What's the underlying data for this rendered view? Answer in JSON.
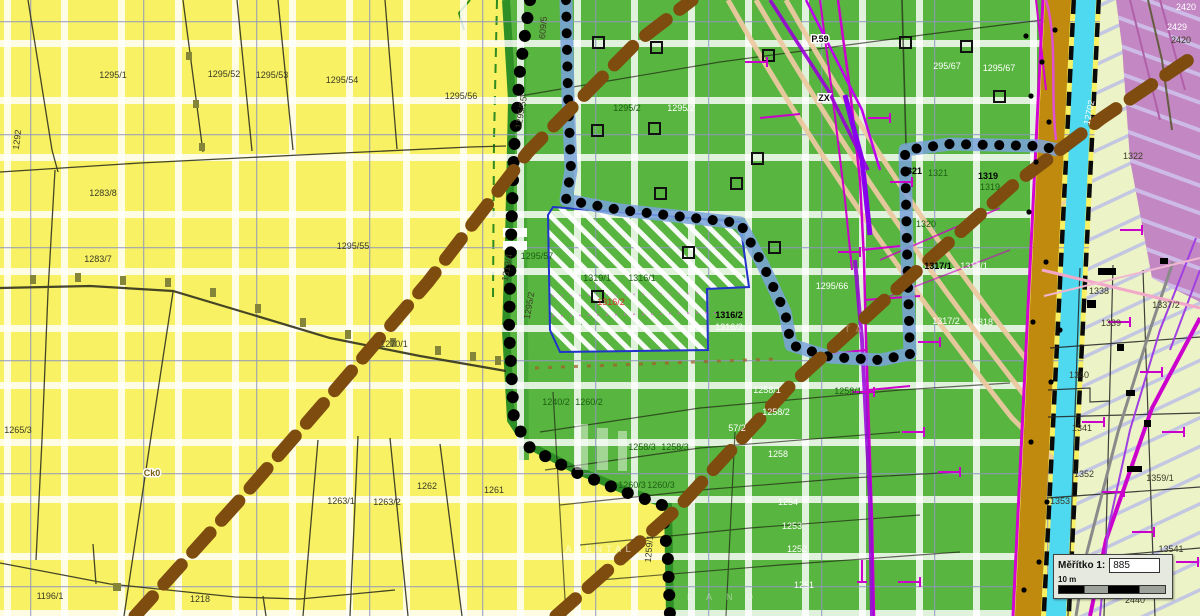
{
  "map": {
    "region_labels": {
      "plan_code": "P.59",
      "zone_code": "ZX",
      "area_code": "Ck0"
    },
    "watermark": {
      "line1": "ASENTAL",
      "line2": "LAND",
      "fragment": "TAL"
    },
    "scalebox": {
      "label": "Měřítko 1:",
      "value": "885",
      "bar_label": "10 m"
    },
    "colors": {
      "farmland_yellow": "#f7f163",
      "zone_green": "#58b53f",
      "boundary_blue_band": "#7aa2dc",
      "corridor_ochre": "#bf8a0e",
      "corridor_cyan": "#4ed9f0",
      "mauve_zone": "#c387c3",
      "pale_parcels": "#ecf3c6",
      "utility_magenta": "#cc00cc",
      "plan_line_brown": "#7e4c0f",
      "subject_outline_blue": "#2233cc"
    },
    "labels": [
      {
        "t": "1292",
        "x": 20,
        "y": 140,
        "c": "dk",
        "r": -83
      },
      {
        "t": "1295/1",
        "x": 113,
        "y": 78,
        "c": "dk"
      },
      {
        "t": "1295/52",
        "x": 224,
        "y": 77,
        "c": "dk"
      },
      {
        "t": "1295/53",
        "x": 272,
        "y": 78,
        "c": "dk"
      },
      {
        "t": "1295/54",
        "x": 342,
        "y": 83,
        "c": "dk"
      },
      {
        "t": "1295/56",
        "x": 461,
        "y": 99,
        "c": "dk"
      },
      {
        "t": "1283/8",
        "x": 103,
        "y": 196,
        "c": "dk"
      },
      {
        "t": "1283/7",
        "x": 98,
        "y": 262,
        "c": "dk"
      },
      {
        "t": "1295/55",
        "x": 353,
        "y": 249,
        "c": "dk"
      },
      {
        "t": "1270/1",
        "x": 394,
        "y": 347,
        "c": "dk"
      },
      {
        "t": "1265/3",
        "x": 18,
        "y": 433,
        "c": "dk"
      },
      {
        "t": "1263/1",
        "x": 341,
        "y": 504,
        "c": "dk"
      },
      {
        "t": "1263/2",
        "x": 387,
        "y": 505,
        "c": "dk"
      },
      {
        "t": "1262",
        "x": 427,
        "y": 489,
        "c": "dk"
      },
      {
        "t": "1261",
        "x": 494,
        "y": 493,
        "c": "dk"
      },
      {
        "t": "1218",
        "x": 200,
        "y": 602,
        "c": "dk"
      },
      {
        "t": "1196/1",
        "x": 50,
        "y": 599,
        "c": "dk"
      },
      {
        "t": "1295/55",
        "x": 524,
        "y": 113,
        "c": "dk",
        "r": -80
      },
      {
        "t": "609/5",
        "x": 546,
        "y": 28,
        "c": "dk",
        "r": -85
      },
      {
        "t": "295/67",
        "x": 947,
        "y": 69,
        "c": "wh"
      },
      {
        "t": "1295/67",
        "x": 999,
        "y": 71,
        "c": "wh"
      },
      {
        "t": "1295/2",
        "x": 627,
        "y": 111,
        "c": "gn"
      },
      {
        "t": "1295/2",
        "x": 681,
        "y": 111,
        "c": "wh"
      },
      {
        "t": "1295/57",
        "x": 537,
        "y": 259,
        "c": "gn"
      },
      {
        "t": "1319/1",
        "x": 597,
        "y": 281,
        "c": "gn"
      },
      {
        "t": "1316/1",
        "x": 642,
        "y": 281,
        "c": "gn"
      },
      {
        "t": "1316/2",
        "x": 611,
        "y": 305,
        "c": "rd"
      },
      {
        "t": "1316/2",
        "x": 729,
        "y": 318,
        "c": "bk"
      },
      {
        "t": "1316/2",
        "x": 729,
        "y": 330,
        "c": "wh"
      },
      {
        "t": "1321",
        "x": 912,
        "y": 174,
        "c": "bk"
      },
      {
        "t": "1321",
        "x": 938,
        "y": 176,
        "c": "gn"
      },
      {
        "t": "1319",
        "x": 988,
        "y": 179,
        "c": "bk"
      },
      {
        "t": "1319",
        "x": 990,
        "y": 190,
        "c": "gn"
      },
      {
        "t": "1320",
        "x": 926,
        "y": 227,
        "c": "gn"
      },
      {
        "t": "1317/1",
        "x": 938,
        "y": 269,
        "c": "bk"
      },
      {
        "t": "1317/1",
        "x": 974,
        "y": 269,
        "c": "wh"
      },
      {
        "t": "1295/66",
        "x": 832,
        "y": 289,
        "c": "wh"
      },
      {
        "t": "1317/2",
        "x": 946,
        "y": 324,
        "c": "wh"
      },
      {
        "t": "1318",
        "x": 983,
        "y": 325,
        "c": "wh"
      },
      {
        "t": "1258/1",
        "x": 767,
        "y": 393,
        "c": "wh"
      },
      {
        "t": "1258/1",
        "x": 848,
        "y": 394,
        "c": "gn"
      },
      {
        "t": "1258/2",
        "x": 776,
        "y": 415,
        "c": "wh"
      },
      {
        "t": "1240/2",
        "x": 556,
        "y": 405,
        "c": "gn"
      },
      {
        "t": "1260/2",
        "x": 589,
        "y": 405,
        "c": "gn"
      },
      {
        "t": "1258/3",
        "x": 642,
        "y": 450,
        "c": "gn"
      },
      {
        "t": "1258/3",
        "x": 675,
        "y": 450,
        "c": "gn"
      },
      {
        "t": "57/2",
        "x": 737,
        "y": 431,
        "c": "wh"
      },
      {
        "t": "1258",
        "x": 778,
        "y": 457,
        "c": "wh"
      },
      {
        "t": "1254",
        "x": 788,
        "y": 505,
        "c": "wh"
      },
      {
        "t": "1253",
        "x": 792,
        "y": 529,
        "c": "wh"
      },
      {
        "t": "1252",
        "x": 797,
        "y": 552,
        "c": "wh"
      },
      {
        "t": "1251",
        "x": 804,
        "y": 588,
        "c": "wh"
      },
      {
        "t": "1260/3",
        "x": 632,
        "y": 488,
        "c": "gn"
      },
      {
        "t": "1260/3",
        "x": 661,
        "y": 488,
        "c": "gn"
      },
      {
        "t": "1259/1",
        "x": 652,
        "y": 549,
        "c": "dk",
        "r": -85
      },
      {
        "t": "1295/2",
        "x": 532,
        "y": 306,
        "c": "dk",
        "r": -80
      },
      {
        "t": "1319/4",
        "x": 510,
        "y": 268,
        "c": "dk",
        "r": -80
      },
      {
        "t": "12702",
        "x": 1092,
        "y": 113,
        "c": "wh",
        "r": -78
      },
      {
        "t": "2420",
        "x": 1186,
        "y": 10,
        "c": "wh"
      },
      {
        "t": "2429",
        "x": 1177,
        "y": 30,
        "c": "wh"
      },
      {
        "t": "2420",
        "x": 1181,
        "y": 43,
        "c": "dk"
      },
      {
        "t": "1322",
        "x": 1133,
        "y": 159,
        "c": "dk"
      },
      {
        "t": "1337/2",
        "x": 1166,
        "y": 308,
        "c": "dk"
      },
      {
        "t": "1338",
        "x": 1099,
        "y": 294,
        "c": "dk"
      },
      {
        "t": "1339",
        "x": 1111,
        "y": 326,
        "c": "dk"
      },
      {
        "t": "1340",
        "x": 1079,
        "y": 378,
        "c": "dk"
      },
      {
        "t": "1341",
        "x": 1082,
        "y": 431,
        "c": "dk"
      },
      {
        "t": "1352",
        "x": 1084,
        "y": 477,
        "c": "dk"
      },
      {
        "t": "1353",
        "x": 1060,
        "y": 504,
        "c": "dk"
      },
      {
        "t": "1359/1",
        "x": 1160,
        "y": 481,
        "c": "dk"
      },
      {
        "t": "13541",
        "x": 1171,
        "y": 552,
        "c": "dk"
      },
      {
        "t": "2440",
        "x": 1135,
        "y": 603,
        "c": "dk"
      },
      {
        "t": "P.59",
        "x": 820,
        "y": 42,
        "c": "big"
      },
      {
        "t": "ZX",
        "x": 824,
        "y": 101,
        "c": "zx"
      },
      {
        "t": "Ck0",
        "x": 152,
        "y": 476,
        "c": "ck0"
      },
      {
        "t": "ASENTAL",
        "x": 600,
        "y": 552,
        "c": "wm1"
      },
      {
        "t": "LAND",
        "x": 727,
        "y": 600,
        "c": "wm2"
      },
      {
        "t": "TAL",
        "x": 862,
        "y": 332,
        "c": "wm3"
      }
    ],
    "open_squares": [
      [
        593,
        37
      ],
      [
        651,
        42
      ],
      [
        763,
        50
      ],
      [
        900,
        37
      ],
      [
        961,
        41
      ],
      [
        994,
        91
      ],
      [
        592,
        125
      ],
      [
        649,
        123
      ],
      [
        752,
        153
      ],
      [
        655,
        188
      ],
      [
        683,
        247
      ],
      [
        769,
        242
      ],
      [
        731,
        178
      ],
      [
        592,
        291
      ]
    ],
    "filled_buildings": [
      [
        1098,
        268,
        18,
        7
      ],
      [
        1087,
        300,
        9,
        8
      ],
      [
        1117,
        344,
        7,
        7
      ],
      [
        1126,
        390,
        9,
        6
      ],
      [
        1144,
        420,
        7,
        7
      ],
      [
        1127,
        466,
        15,
        6
      ],
      [
        1149,
        556,
        8,
        13
      ],
      [
        1107,
        582,
        11,
        7
      ],
      [
        1160,
        258,
        8,
        6
      ]
    ],
    "tree_dots": [
      [
        1026,
        36
      ],
      [
        1042,
        62
      ],
      [
        1031,
        96
      ],
      [
        1049,
        122
      ],
      [
        1036,
        162
      ],
      [
        1029,
        212
      ],
      [
        1046,
        262
      ],
      [
        1033,
        322
      ],
      [
        1051,
        382
      ],
      [
        1031,
        442
      ],
      [
        1047,
        502
      ],
      [
        1039,
        562
      ],
      [
        1024,
        590
      ],
      [
        1055,
        30
      ],
      [
        1060,
        330
      ]
    ],
    "t_marks": [
      [
        890,
        182,
        "h"
      ],
      [
        918,
        342,
        "h"
      ],
      [
        852,
        392,
        "h"
      ],
      [
        902,
        432,
        "h"
      ],
      [
        938,
        472,
        "h"
      ],
      [
        862,
        560,
        "v"
      ],
      [
        898,
        582,
        "h"
      ],
      [
        1108,
        322,
        "h"
      ],
      [
        1140,
        372,
        "h"
      ],
      [
        1102,
        492,
        "h"
      ],
      [
        1132,
        532,
        "h"
      ],
      [
        1162,
        432,
        "h"
      ],
      [
        1176,
        562,
        "h"
      ],
      [
        1082,
        422,
        "h"
      ],
      [
        868,
        118,
        "h"
      ],
      [
        838,
        252,
        "h"
      ],
      [
        1120,
        230,
        "h"
      ],
      [
        745,
        62,
        "h"
      ]
    ]
  }
}
